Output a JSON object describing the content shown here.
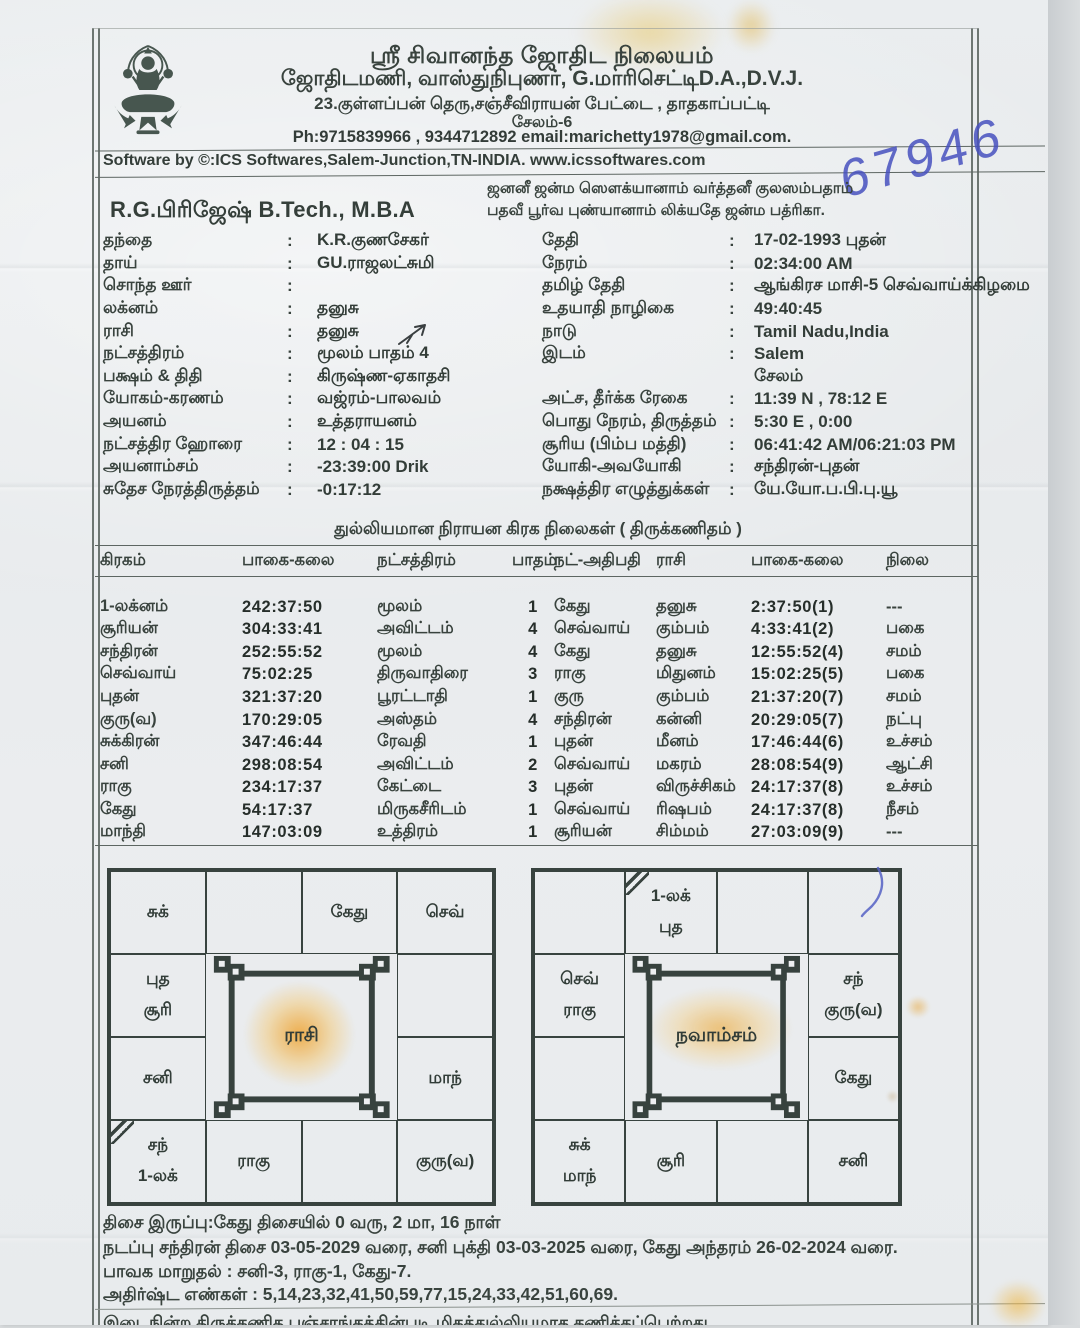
{
  "palette": {
    "ink": "#38423d",
    "chart_line": "#38433f",
    "stain_orange": "#ee9e26",
    "pen_blue": "#4650be",
    "paper": "#e9ecee"
  },
  "header": {
    "org_name": "ஸ்ரீ சிவானந்த ஜோதிட நிலையம்",
    "credentials": "ஜோதிடமணி, வாஸ்துநிபுணர், G.மாரிசெட்டிD.A.,D.V.J.",
    "address": "23.குள்ளப்பன் தெரு,சஞ்சீவிராயன் பேட்டை , தாதகாப்பட்டி",
    "city": "சேலம்-6",
    "contact": "Ph:9715839966 , 9344712892 email:marichetty1978@gmail.com.",
    "logo": "lakshmi-emblem"
  },
  "software_line": "Software by ©:ICS Softwares,Salem-Junction,TN-INDIA. www.icssoftwares.com",
  "handwritten_number": "67946",
  "sloka": {
    "line1": "ஜனனீ ஜன்ம ஸௌக்யானாம் வர்த்தனீ குலஸம்பதாம்",
    "line2": "பதவீ பூர்வ புண்யானாம் லிக்யதே ஜன்ம பத்ரிகா."
  },
  "person_name": "R.G.பிரிஜேஷ் B.Tech., M.B.A",
  "details_left": {
    "rows": [
      {
        "label": "தந்தை",
        "colon": ":",
        "value": "K.R.குணசேகர்"
      },
      {
        "label": "தாய்",
        "colon": ":",
        "value": "GU.ராஜலட்சுமி"
      },
      {
        "label": "சொந்த ஊர்",
        "colon": ":",
        "value": ""
      },
      {
        "label": "லக்னம்",
        "colon": ":",
        "value": "தனுசு"
      },
      {
        "label": "ராசி",
        "colon": ":",
        "value": "தனுசு"
      },
      {
        "label": "நட்சத்திரம்",
        "colon": ":",
        "value": "மூலம் பாதம் 4"
      },
      {
        "label": "பக்ஷம் & திதி",
        "colon": ":",
        "value": "கிருஷ்ண-ஏகாதசி"
      },
      {
        "label": "யோகம்-கரணம்",
        "colon": ":",
        "value": "வஜ்ரம்-பாலவம்"
      },
      {
        "label": "அயனம்",
        "colon": ":",
        "value": "உத்தராயனம்"
      },
      {
        "label": "நட்சத்திர ஹோரை",
        "colon": ":",
        "value": "12 : 04 : 15"
      },
      {
        "label": "அயனாம்சம்",
        "colon": ":",
        "value": "-23:39:00 Drik"
      },
      {
        "label": "சுதேச நேரத்திருத்தம்",
        "colon": ":",
        "value": "-0:17:12"
      }
    ]
  },
  "details_right": {
    "rows": [
      {
        "label": "தேதி",
        "colon": ":",
        "value": "17-02-1993 புதன்"
      },
      {
        "label": "நேரம்",
        "colon": ":",
        "value": "02:34:00 AM"
      },
      {
        "label": "தமிழ் தேதி",
        "colon": ":",
        "value": "ஆங்கிரச மாசி-5 செவ்வாய்க்கிழமை"
      },
      {
        "label": "உதயாதி நாழிகை",
        "colon": ":",
        "value": "49:40:45"
      },
      {
        "label": "நாடு",
        "colon": ":",
        "value": "Tamil Nadu,India"
      },
      {
        "label": "இடம்",
        "colon": ":",
        "value": "Salem"
      },
      {
        "label": "",
        "colon": "",
        "value": "சேலம்"
      },
      {
        "label": "அட்ச, தீர்க்க ரேகை",
        "colon": ":",
        "value": "11:39 N , 78:12 E"
      },
      {
        "label": "பொது நேரம், திருத்தம்",
        "colon": ":",
        "value": "5:30 E , 0:00"
      },
      {
        "label": "சூரிய (பிம்ப மத்தி)",
        "colon": ":",
        "value": "06:41:42 AM/06:21:03 PM"
      },
      {
        "label": "யோகி-அவயோகி",
        "colon": ":",
        "value": "சந்திரன்-புதன்"
      },
      {
        "label": "நக்ஷத்திர எழுத்துக்கள்",
        "colon": ":",
        "value": "யே.யோ.ப.பி.பு.யூ"
      }
    ]
  },
  "planet_table": {
    "title": "துல்லியமான நிராயன கிரக நிலைகள் ( திருக்கணிதம் )",
    "headers": [
      "கிரகம்",
      "பாகை-கலை",
      "நட்சத்திரம்",
      "பாதம்",
      "நட்-அதிபதி",
      "ராசி",
      "பாகை-கலை",
      "நிலை"
    ],
    "rows": [
      [
        "1-லக்னம்",
        "242:37:50",
        "மூலம்",
        "1",
        "கேது",
        "தனுசு",
        "2:37:50(1)",
        "---"
      ],
      [
        "சூரியன்",
        "304:33:41",
        "அவிட்டம்",
        "4",
        "செவ்வாய்",
        "கும்பம்",
        "4:33:41(2)",
        "பகை"
      ],
      [
        "சந்திரன்",
        "252:55:52",
        "மூலம்",
        "4",
        "கேது",
        "தனுசு",
        "12:55:52(4)",
        "சமம்"
      ],
      [
        "செவ்வாய்",
        "75:02:25",
        "திருவாதிரை",
        "3",
        "ராகு",
        "மிதுனம்",
        "15:02:25(5)",
        "பகை"
      ],
      [
        "புதன்",
        "321:37:20",
        "பூரட்டாதி",
        "1",
        "குரு",
        "கும்பம்",
        "21:37:20(7)",
        "சமம்"
      ],
      [
        "குரு(வ)",
        "170:29:05",
        "அஸ்தம்",
        "4",
        "சந்திரன்",
        "கன்னி",
        "20:29:05(7)",
        "நட்பு"
      ],
      [
        "சுக்கிரன்",
        "347:46:44",
        "ரேவதி",
        "1",
        "புதன்",
        "மீனம்",
        "17:46:44(6)",
        "உச்சம்"
      ],
      [
        "சனி",
        "298:08:54",
        "அவிட்டம்",
        "2",
        "செவ்வாய்",
        "மகரம்",
        "28:08:54(9)",
        "ஆட்சி"
      ],
      [
        "ராகு",
        "234:17:37",
        "கேட்டை",
        "3",
        "புதன்",
        "விருச்சிகம்",
        "24:17:37(8)",
        "உச்சம்"
      ],
      [
        "கேது",
        "54:17:37",
        "மிருகசீரிடம்",
        "1",
        "செவ்வாய்",
        "ரிஷபம்",
        "24:17:37(8)",
        "நீசம்"
      ],
      [
        "மாந்தி",
        "147:03:09",
        "உத்திரம்",
        "1",
        "சூரியன்",
        "சிம்மம்",
        "27:03:09(9)",
        "---"
      ]
    ]
  },
  "rasi_chart": {
    "title": "ராசி",
    "cells": [
      {
        "l1": "சுக்",
        "l2": ""
      },
      {
        "l1": "",
        "l2": ""
      },
      {
        "l1": "கேது",
        "l2": ""
      },
      {
        "l1": "செவ்",
        "l2": ""
      },
      {
        "l1": "புத",
        "l2": "சூரி"
      },
      {
        "l1": "",
        "l2": ""
      },
      {
        "l1": "சனி",
        "l2": ""
      },
      {
        "l1": "மாந்",
        "l2": ""
      },
      {
        "l1": "சந்",
        "l2": "1-லக்"
      },
      {
        "l1": "ராகு",
        "l2": ""
      },
      {
        "l1": "",
        "l2": ""
      },
      {
        "l1": "குரு(வ)",
        "l2": ""
      }
    ],
    "lagna_cell_index": 8
  },
  "navamsa_chart": {
    "title": "நவாம்சம்",
    "cells": [
      {
        "l1": "",
        "l2": ""
      },
      {
        "l1": "1-லக்",
        "l2": "புத"
      },
      {
        "l1": "",
        "l2": ""
      },
      {
        "l1": "",
        "l2": ""
      },
      {
        "l1": "செவ்",
        "l2": "ராகு"
      },
      {
        "l1": "சந்",
        "l2": "குரு(வ)"
      },
      {
        "l1": "",
        "l2": ""
      },
      {
        "l1": "கேது",
        "l2": ""
      },
      {
        "l1": "சுக்",
        "l2": "மாந்"
      },
      {
        "l1": "சூரி",
        "l2": ""
      },
      {
        "l1": "",
        "l2": ""
      },
      {
        "l1": "சனி",
        "l2": ""
      }
    ],
    "lagna_cell_index": 1
  },
  "footer": {
    "line1": "திசை இருப்பு:கேது திசையில் 0 வரு, 2 மா, 16 நாள்",
    "line2": "நடப்பு சந்திரன் திசை 03-05-2029 வரை, சனி புக்தி 03-03-2025 வரை, கேது அந்தரம் 26-02-2024 வரை.",
    "line3": "பாவக மாறுதல் : சனி-3, ராகு-1, கேது-7.",
    "line4": "அதிர்ஷ்ட எண்கள் : 5,14,23,32,41,50,59,77,15,24,33,42,51,60,69.",
    "clipped_line": "இடைநின்ற திருக்கணித பஞ்சாங்கத்தின்படி மிகத்துல்லியமாக கணிக்கப்பெற்றது"
  }
}
